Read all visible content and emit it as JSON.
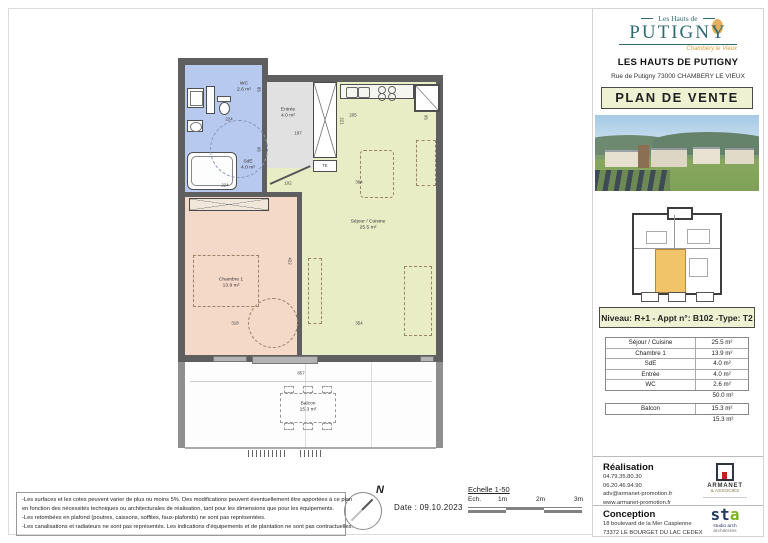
{
  "branding": {
    "logo_top": "Les Hauts de",
    "logo_main": "PUTIGN",
    "logo_y": "Y",
    "logo_subtitle": "Chambéry le Vieux"
  },
  "header": {
    "title": "LES HAUTS DE PUTIGNY",
    "address": "Rue de Putigny 73000 CHAMBERY LE VIEUX",
    "doc_type": "PLAN DE VENTE"
  },
  "unit": {
    "label": "Niveau: R+1 - Appt n°: B102 -Type: T2"
  },
  "areas": {
    "rows": [
      {
        "label": "Séjour / Cuisine",
        "value": "25.5 m²"
      },
      {
        "label": "Chambre 1",
        "value": "13.9 m²"
      },
      {
        "label": "SdE",
        "value": "4.0 m²"
      },
      {
        "label": "Entrée",
        "value": "4.0 m²"
      },
      {
        "label": "WC",
        "value": "2.6 m²"
      }
    ],
    "total": "50.0 m²",
    "balcony_row": {
      "label": "Balcon",
      "value": "15.3 m²"
    },
    "balcony_total": "15.3 m²"
  },
  "plan": {
    "rooms": {
      "wc": {
        "name": "WC",
        "area": "2.6 m²"
      },
      "sde": {
        "name": "SdE",
        "area": "4.0 m²"
      },
      "entree": {
        "name": "Entrée",
        "area": "4.0 m²"
      },
      "sejour": {
        "name": "Séjour / Cuisine",
        "area": "25.5 m²"
      },
      "chambre": {
        "name": "Chambre 1",
        "area": "13.9 m²"
      },
      "balcon": {
        "name": "Balcon",
        "area": "15.3 m²"
      }
    },
    "cotes": [
      "224",
      "85",
      "65",
      "224",
      "187",
      "102",
      "205",
      "65",
      "221",
      "364",
      "354",
      "422",
      "318",
      "857"
    ],
    "te_label": "TE"
  },
  "footer": {
    "north": "N",
    "date": "Date : 09.10.2023",
    "scale_title": "Echelle 1-50",
    "scale_prefix": "Ech.",
    "scale_ticks": [
      "1m",
      "2m",
      "3m"
    ],
    "legal_lines": [
      "-Les surfaces et les cotes peuvent varier de plus ou moins 5%. Des modifications peuvent éventuellement être apportées à ce plan",
      "en fonction des nécessités techniques ou architecturales de réalisation, tant pour les dimensions que pour les équipements.",
      "-Les retombées en plafond (poutres, caissons, soffites, faux-plafonds) ne sont pas représentées.",
      "-Les canalisations et radiateurs ne sont pas représentés. Les indications d'équipements et de plantation ne sont pas contractuelles."
    ]
  },
  "contacts": {
    "realisation": {
      "title": "Réalisation",
      "lines": [
        "04.79.35.80.30",
        "06.20.46.94.90",
        "adv@armanet-promotion.fr",
        "www.armanet-promotion.fr"
      ]
    },
    "conception": {
      "title": "Conception",
      "lines": [
        "18 boulevard de la Mer Caspienne",
        "73372 LE BOURGET DU LAC CEDEX"
      ]
    },
    "armanet_logo": {
      "name": "ARMANET",
      "sub": "& ASSOCIÉS"
    },
    "sta_logo": {
      "st": "st",
      "a": "a",
      "caption1": "studio arch",
      "caption2": "architectes"
    }
  },
  "colors": {
    "teal": "#2f6b72",
    "orange": "#dd9c3c",
    "wall": "#5f5f5f",
    "room_blue": "#b7c9ee",
    "room_green": "#e9edc6",
    "room_salmon": "#f5d9c8",
    "room_gray": "#e1e1e1",
    "doc_box_bg": "#eef2d3",
    "unit_highlight": "#f2c469"
  }
}
